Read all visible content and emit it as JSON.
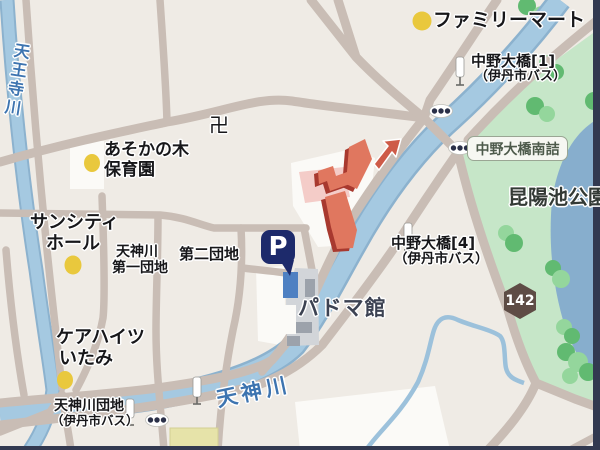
{
  "map": {
    "title": "あそか苑",
    "labels": {
      "familymart": "ファミリーマート",
      "temple_symbol": "卍",
      "nursery_line1": "あそかの木",
      "nursery_line2": "保育園",
      "tennoji_river": "天王寺川",
      "suncity_line1": "サンシティ",
      "suncity_line2": "ホール",
      "daiichi_line1": "天神川",
      "daiichi_line2": "第一団地",
      "daini_danchi": "第二団地",
      "care_line1": "ケアハイツ",
      "care_line2": "いたみ",
      "tenjin_danchi_line1": "天神川団地",
      "tenjin_danchi_line2": "（伊丹市バス）",
      "tenjin_river": "天神川",
      "padoma_kan": "パドマ館",
      "konyoike_park": "昆陽池公園",
      "parking": "P",
      "route_number": "142",
      "bus1_line1": "中野大橋[1]",
      "bus1_line2": "（伊丹市バス）",
      "bus4_line1": "中野大橋[4]",
      "bus4_line2": "（伊丹市バス）",
      "pill_minamizume": "中野大橋南詰"
    },
    "colors": {
      "bg": "#EFEBE5",
      "road": "#C9BDB5",
      "river": "#A5C9E1",
      "river_edge": "#8CB2CE",
      "stream": "#9CC1DB",
      "park": "#C6E6C8",
      "pond": "#87AECD",
      "tree": "#61BA71",
      "tree_light": "#94D69C",
      "white_area": "#FBFAF7",
      "building": "#E0775F",
      "building_shadow": "#A8392F",
      "pink": "#F4CCC8",
      "title": "#D45B49",
      "yellow_dot": "#E9C83D",
      "yellow_building": "#E6E3A9",
      "grey_building": "#D2D5D9",
      "grey_building_dark": "#9CA2AB",
      "parking_navy": "#1D2A6B",
      "parking_blue": "#4E80C2",
      "route_badge": "#5E4C45",
      "pill_bg": "#F6F7F2",
      "pill_border": "#9AA694",
      "pill_text": "#4D5A4B",
      "blue_text": "#3D74B0",
      "black_text": "#17171A",
      "grey_text": "#3C4252",
      "park_text": "#333A35",
      "edge_shadow": "#323950"
    }
  }
}
